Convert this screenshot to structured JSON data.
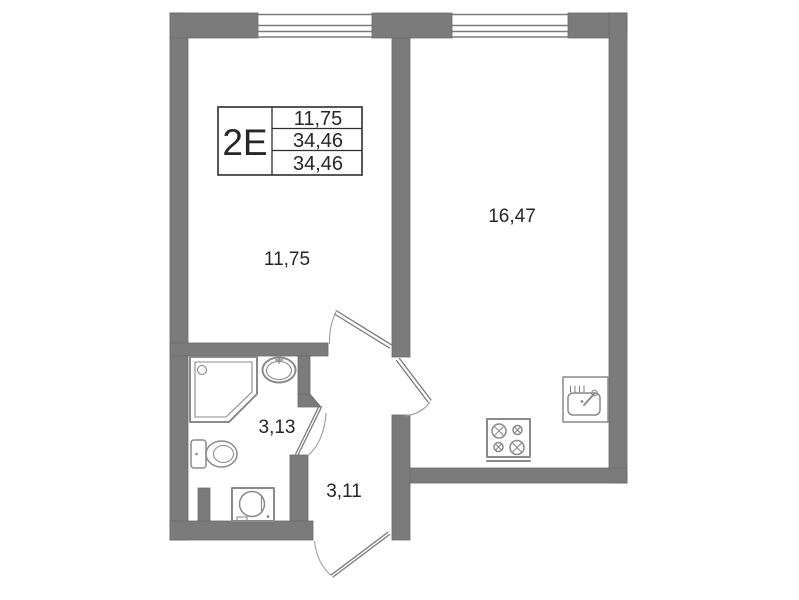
{
  "legend": {
    "flat_type": "2Е",
    "areas": [
      "11,75",
      "34,46",
      "34,46"
    ]
  },
  "rooms": [
    {
      "name": "living-room",
      "area": "11,75"
    },
    {
      "name": "kitchen-living-room",
      "area": "16,47"
    },
    {
      "name": "bathroom",
      "area": "3,13"
    },
    {
      "name": "hallway",
      "area": "3,11"
    }
  ],
  "fixtures": {
    "bathroom": [
      "shower-cabin",
      "washbasin",
      "toilet",
      "washing-machine"
    ],
    "kitchen": [
      "cooktop-4-burners",
      "kitchen-sink"
    ],
    "windows": 2,
    "doors": [
      "living-room-door",
      "kitchen-door",
      "bathroom-door",
      "entrance-door"
    ]
  },
  "colors": {
    "background": "#ffffff",
    "wall": "#7b7b7b",
    "wall_edge": "#6a6a6a",
    "fixture": "#8a8a8a",
    "door_leaf": "#7a7a7a",
    "door_arc": "#9c9c9c",
    "text": "#262626",
    "legend_border": "#2e2e2e"
  }
}
